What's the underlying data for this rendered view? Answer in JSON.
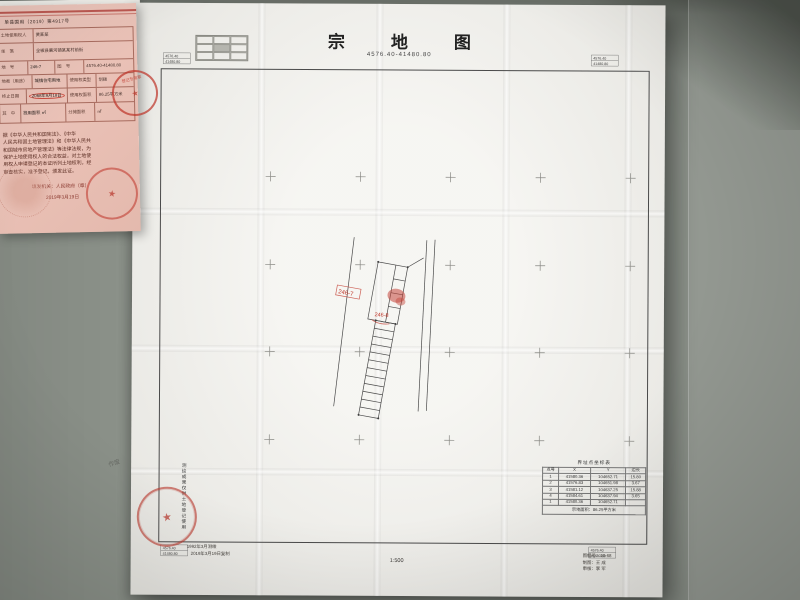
{
  "colors": {
    "seal_red": "#c0392b",
    "doc_pink": "#eac3b9",
    "paper": "#f2f1ec",
    "desk": "#8b9189"
  },
  "map": {
    "title": "宗地图",
    "sheet_no": "4576.40-41480.80",
    "scale": "1:500",
    "corner": {
      "a": "4576.40",
      "b": "41480.80"
    },
    "parcel": {
      "label_a": "246-7",
      "label_b": "246-8"
    },
    "coord_table": {
      "title": "界址点坐标表",
      "headers": {
        "n": "点号",
        "x": "X",
        "y": "Y",
        "l": "边长"
      },
      "rows": [
        {
          "n": "1",
          "x": "41580.36",
          "y": "104652.71",
          "l": "15.80"
        },
        {
          "n": "2",
          "x": "41576.83",
          "y": "104651.98",
          "l": "3.67"
        },
        {
          "n": "3",
          "x": "41581.12",
          "y": "104637.25",
          "l": "15.88"
        },
        {
          "n": "4",
          "x": "41584.61",
          "y": "104637.94",
          "l": "3.65"
        },
        {
          "n": "1",
          "x": "41580.36",
          "y": "104652.71",
          "l": ""
        }
      ],
      "footer": "宗地面积：86.25平方米"
    },
    "notes_left": [
      "1992年3月测绘",
      "2019年3月19日复制"
    ],
    "notes_right": [
      "图幅号：10-68",
      "制图：王 成",
      "审核：李 军"
    ],
    "side_note": "测绘成果仅供土地登记使用",
    "pencil_note": "作废"
  },
  "certificate": {
    "header_no": "单县国用（2019）第4917号",
    "rows": [
      {
        "label": "土地使用权人",
        "value": "黄某某",
        "label2": "",
        "value2": ""
      },
      {
        "label": "坐　落",
        "value": "全椒县襄河镇某某村前街",
        "label2": "",
        "value2": ""
      },
      {
        "label": "地　号",
        "value": "246-7",
        "label2": "图　号",
        "value2": "4576.40-41480.80"
      },
      {
        "label": "地类（用途）",
        "value": "城镇住宅用地",
        "label2": "使用权类型",
        "value2": "划拨"
      },
      {
        "label": "终止日期",
        "value": "2068年9月18日",
        "label2": "使用权面积",
        "value2": "86.25平方米"
      },
      {
        "label": "其　中",
        "value": "独用面积 ㎡",
        "label2": "分摊面积",
        "value2": "㎡"
      }
    ],
    "body_lines": [
      "据《中华人民共和国宪法》、《中华",
      "人民共和国土地管理法》和《中华人民共",
      "和国城市房地产管理法》等法律法规，为",
      "保护土地使用权人的合法权益，对土地使",
      "用权人申请登记的本证所列土地权利，经",
      "审查核实，准予登记，颁发此证。"
    ],
    "issuer_label": "填发机关：",
    "issuer": "人民政府（章）",
    "date": "2019年3月19日",
    "seal_star": "★",
    "cross_seal_text": "登记专用章"
  }
}
